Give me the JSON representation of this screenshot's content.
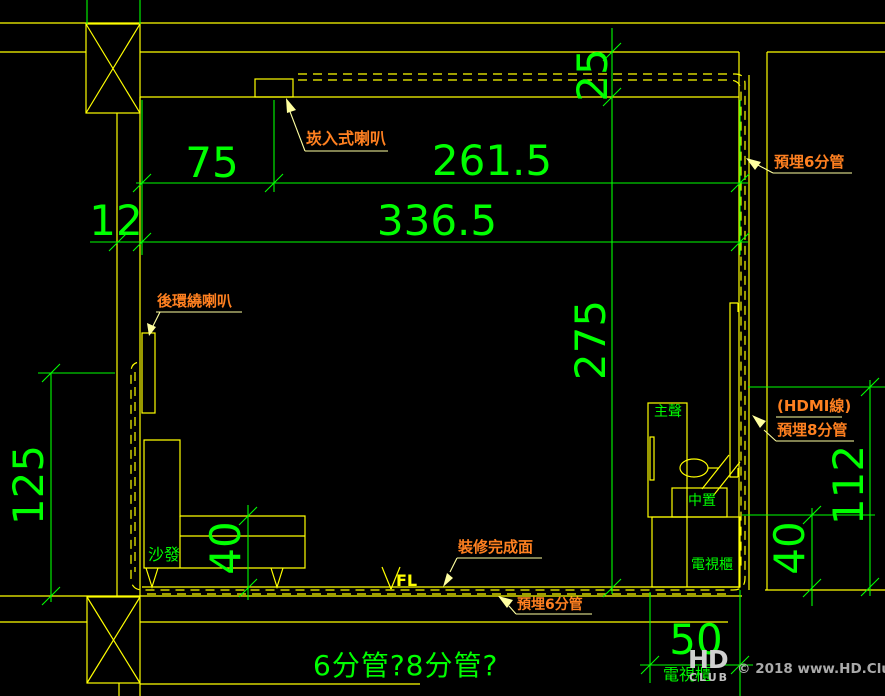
{
  "colors": {
    "background": "#000000",
    "line_yellow": "#ffff00",
    "dim_green": "#00ff00",
    "label_orange": "#ff8020",
    "leader_yellow": "#ffffa0"
  },
  "dimensions": {
    "d75": "75",
    "d261_5": "261.5",
    "d336_5": "336.5",
    "d12": "12",
    "d25": "25",
    "d275": "275",
    "d125": "125",
    "d40_sofa": "40",
    "d40_right": "40",
    "d112": "112",
    "d50": "50"
  },
  "annotations": {
    "recessed_speaker": "崁入式喇叭",
    "embed_6_top": "預埋6分管",
    "rear_surround": "後環繞喇叭",
    "hdmi_line": "(HDMI線)",
    "embed_8": "預埋8分管",
    "finish_surface": "裝修完成面",
    "embed_6_bottom": "預埋6分管",
    "question": "6分管?8分管?"
  },
  "room_items": {
    "sofa": "沙發",
    "main_speaker": "主聲",
    "center_speaker": "中置",
    "tv_cabinet": "電視櫃",
    "tv_cabinet_bottom": "電視櫃",
    "floor_level": "FL"
  },
  "watermark": {
    "logo_top": "HD",
    "logo_bottom": "CLUB",
    "credit": "© 2018 www.HD.Club.tw"
  }
}
